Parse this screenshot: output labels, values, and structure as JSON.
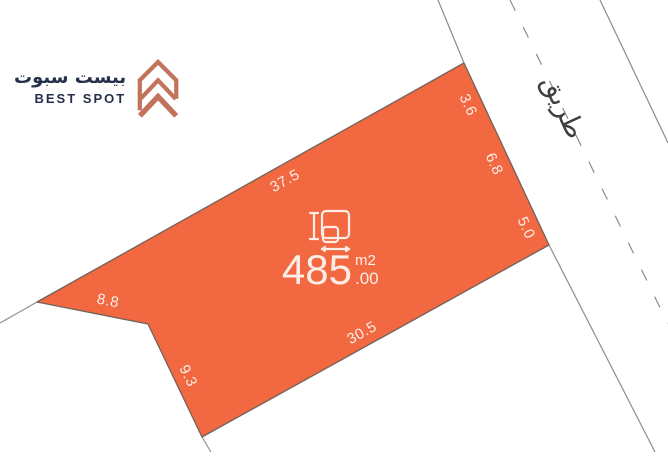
{
  "brand": {
    "name_arabic": "بيست سبوت",
    "name_english": "BEST SPOT",
    "logo_icon": "chevron-house-icon",
    "text_color": "#25304A",
    "logo_color": "#C1735C"
  },
  "road": {
    "label": "طريق",
    "line_color": "#8C8C8C",
    "label_color": "#3E3E3E",
    "centerline_style": "dashed"
  },
  "plot": {
    "fill_color": "#F26840",
    "outline_color": "#70635A",
    "label_color": "#FCEEE7",
    "area_icon": "dimensions-icon",
    "area": {
      "value": "485",
      "decimals": ".00",
      "unit": "m2"
    },
    "dimensions": [
      {
        "edge": "top-left",
        "value": "37.5"
      },
      {
        "edge": "right-upper",
        "value": "3.6"
      },
      {
        "edge": "right-middle",
        "value": "6.8"
      },
      {
        "edge": "right-lower",
        "value": "5.0"
      },
      {
        "edge": "bottom",
        "value": "30.5"
      },
      {
        "edge": "left-lower",
        "value": "9.3"
      },
      {
        "edge": "left-upper",
        "value": "8.8"
      }
    ]
  }
}
